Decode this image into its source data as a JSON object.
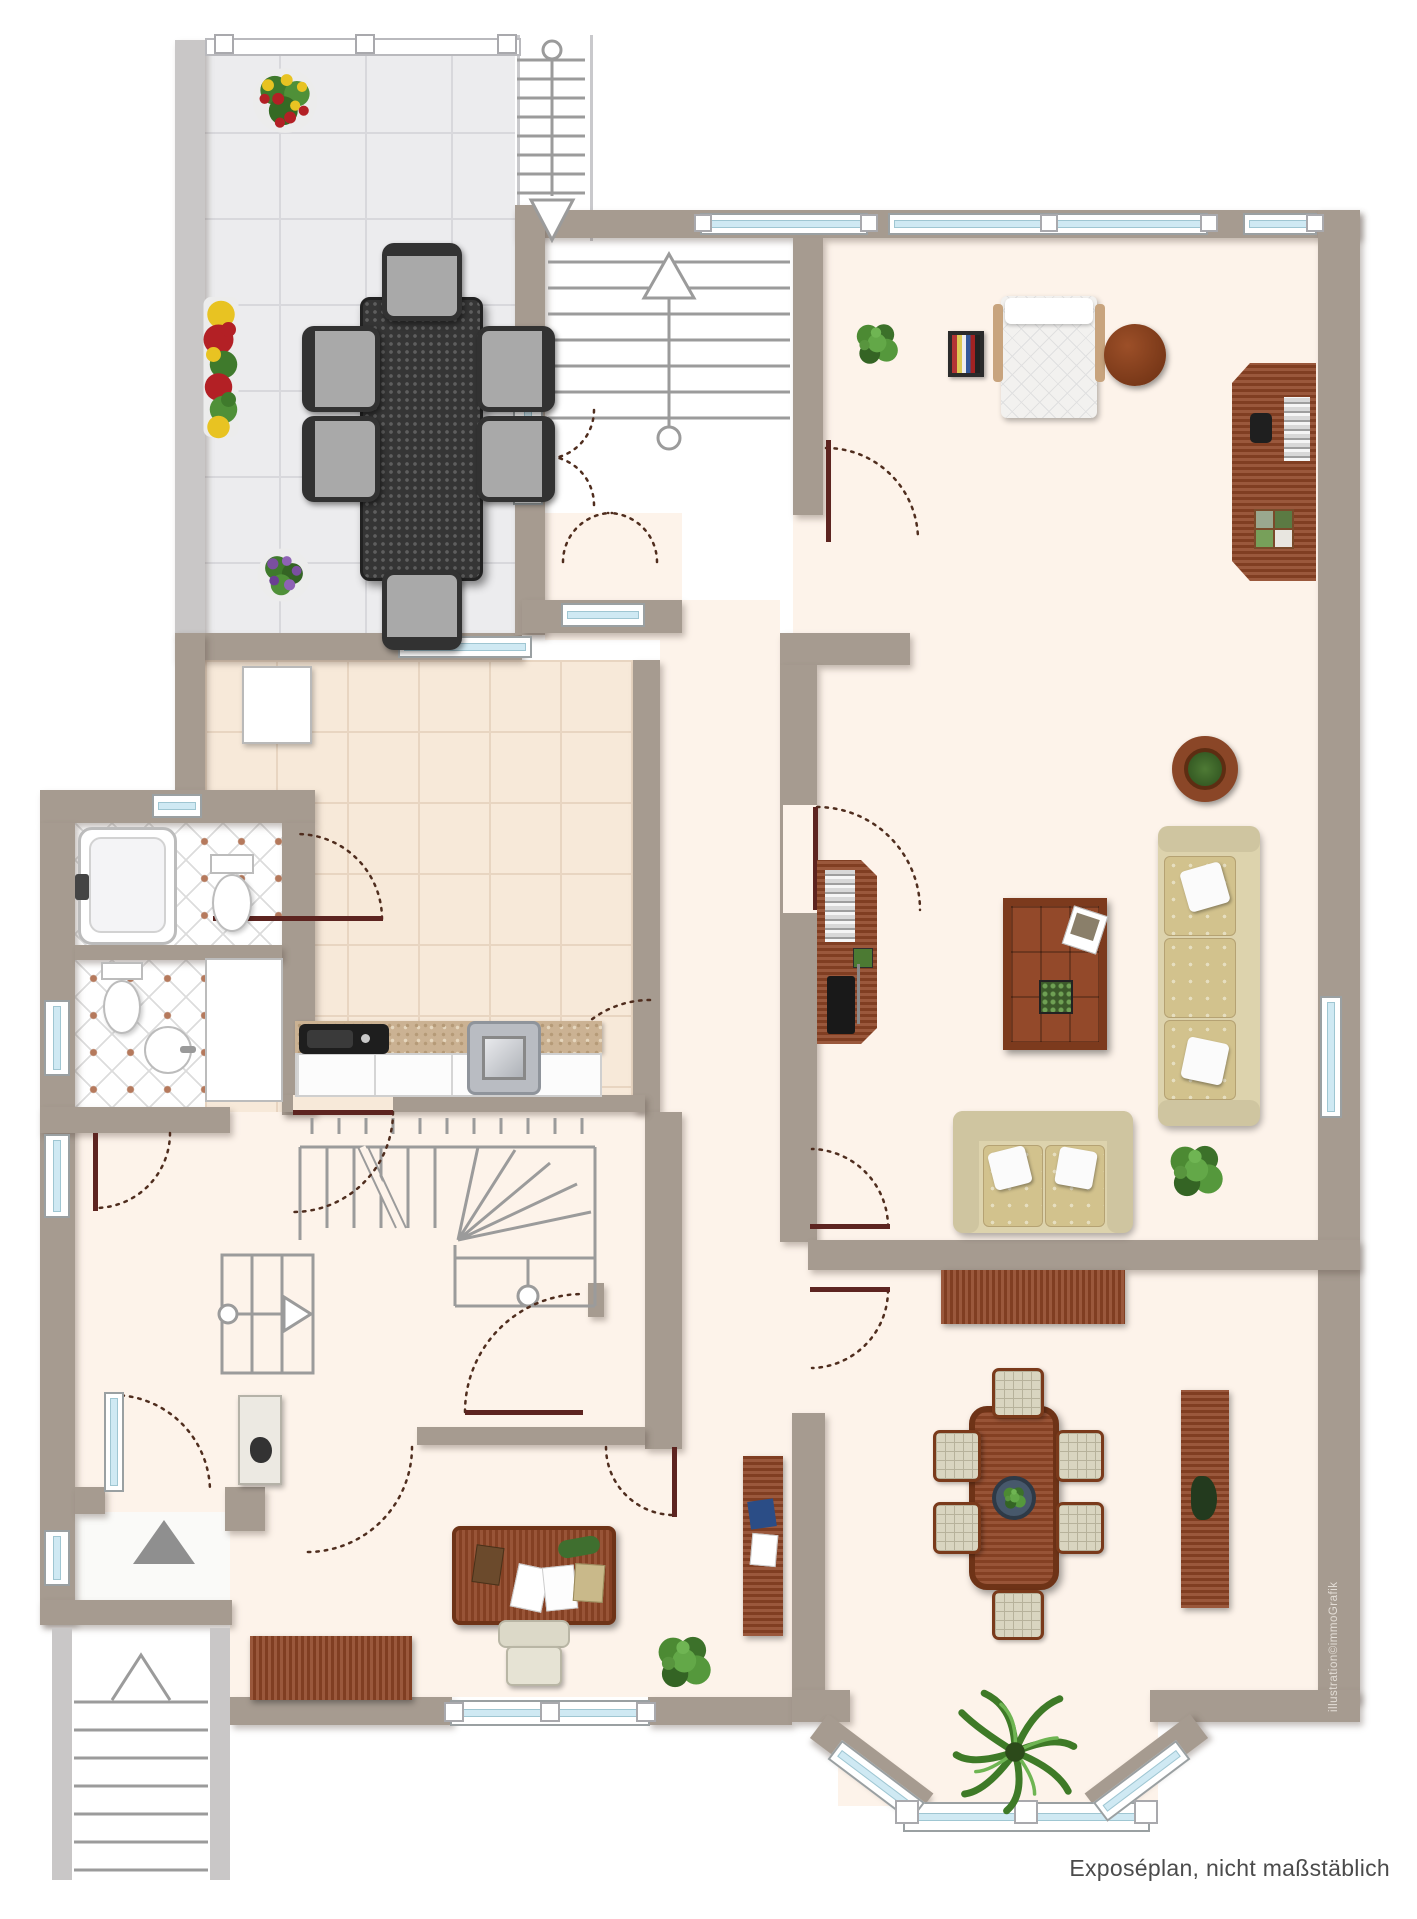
{
  "caption": {
    "text": "Exposéplan, nicht maßstäblich"
  },
  "watermark": {
    "text": "illustration©immoGrafik"
  },
  "palette": {
    "wall": "#a69b90",
    "wall_light": "#c9c7c7",
    "floor_cream": "#fdf3ea",
    "terrace_tile": "#ececee",
    "kitchen_tile": "#f7e9d9",
    "bath_dot": "#b5795c",
    "window_glass": "#cfe9f3",
    "door_leaf": "#5d2420",
    "door_arc": "#4f2d1e",
    "stair_line": "#9b9b9b",
    "wood": "#8f4526",
    "sofa": "#ddd3ad",
    "plant": "#4c8a33"
  },
  "plan": {
    "type": "floor-plan",
    "rooms": [
      {
        "name": "terrace",
        "furniture": [
          "outdoor-dining-table",
          "six-outdoor-chairs",
          "flower-pot-red-yellow",
          "flower-box",
          "flower-pot-purple",
          "railing",
          "exterior-stairs-down"
        ]
      },
      {
        "name": "stairwell",
        "furniture": [
          "staircase-up-arrow",
          "double-door",
          "terrace-door"
        ]
      },
      {
        "name": "study",
        "furniture": [
          "plant",
          "magazine-rack",
          "chaise-lounge",
          "round-side-table",
          "desk-sideboard-with-books",
          "phone",
          "plant-tray"
        ]
      },
      {
        "name": "living-room",
        "furniture": [
          "tv-sideboard",
          "coffee-table",
          "three-seat-sofa",
          "two-seat-sofa",
          "round-table-with-plant",
          "plant"
        ]
      },
      {
        "name": "dining-room",
        "furniture": [
          "sideboard",
          "dining-table-with-bowl",
          "six-dining-chairs",
          "tall-sideboard-with-plant",
          "palm-plant",
          "bay-window"
        ]
      },
      {
        "name": "kitchen",
        "furniture": [
          "corner-cabinet",
          "counter-with-granite-top",
          "sink",
          "stove"
        ]
      },
      {
        "name": "bathroom",
        "furniture": [
          "bathtub",
          "toilet",
          "window"
        ]
      },
      {
        "name": "wc",
        "furniture": [
          "toilet",
          "round-washbasin",
          "closet"
        ]
      },
      {
        "name": "hallway",
        "furniture": [
          "main-winder-staircase",
          "basement-steps-arrow",
          "small-cabinet"
        ]
      },
      {
        "name": "entrance",
        "furniture": [
          "glazed-door",
          "direction-triangle",
          "exterior-stoop-steps",
          "chevron-arrow"
        ]
      },
      {
        "name": "office",
        "furniture": [
          "desk-with-papers",
          "office-chair",
          "sideboard",
          "tall-shelf-with-folder",
          "plant"
        ]
      }
    ]
  }
}
